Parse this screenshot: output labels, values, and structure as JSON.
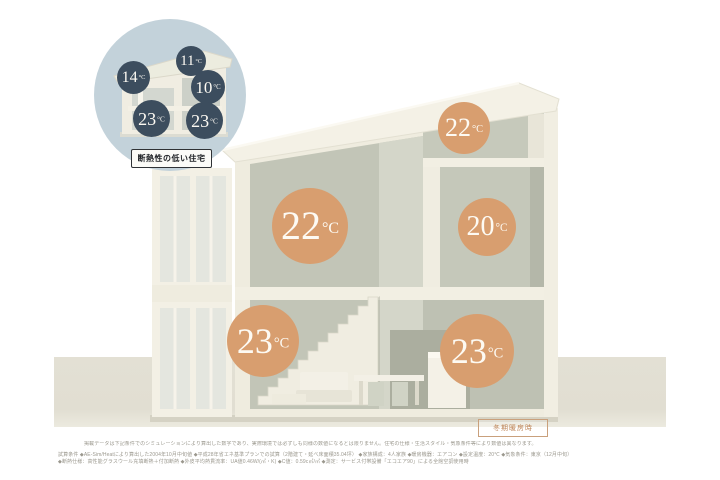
{
  "badge": {
    "label": "冬期暖房時"
  },
  "inset": {
    "caption": "断熱性の低い住宅",
    "temps": [
      {
        "value": "11",
        "unit": "°C"
      },
      {
        "value": "14",
        "unit": "°C"
      },
      {
        "value": "10",
        "unit": "°C"
      },
      {
        "value": "23",
        "unit": "°C"
      },
      {
        "value": "23",
        "unit": "°C"
      }
    ]
  },
  "house": {
    "temps": [
      {
        "value": "22",
        "unit": "°C"
      },
      {
        "value": "22",
        "unit": "°C"
      },
      {
        "value": "20",
        "unit": "°C"
      },
      {
        "value": "23",
        "unit": "°C"
      },
      {
        "value": "23",
        "unit": "°C"
      }
    ]
  },
  "footer": {
    "line1": "掲載データは下記条件でのシミュレーションにより算出した数字であり、実際環境では必ずしも同様の数値になるとは限りません。住宅の仕様・生活スタイル・気象条件等により数値は異なります。",
    "line2": "試算条件 ◆AE-Sim/Heatにより算出した2004年10月中旬値 ◆平成28年省エネ基準プランでの試算（2階建て・延べ床面積35.04坪） ◆家族構成：4人家族 ◆暖房機器：エアコン ◆設定温度：20℃ ◆気象条件：東京（12月中旬）",
    "line3": "◆断熱仕様：高性能グラスウール充填断熱＋付加断熱 ◆外皮平均熱貫流率：UA値0.46W/(㎡・K) ◆C値：0.59c㎡/㎡ ◆測定：サービス付帯設備「エコエア90」による全館空調使用時"
  },
  "colors": {
    "warm_circle": "#d89e6f",
    "cold_circle": "#3c4d5e",
    "inset_bg": "#c3d2da",
    "wall_cream": "#efecdf",
    "interior_gray": "#c2c5b7"
  }
}
